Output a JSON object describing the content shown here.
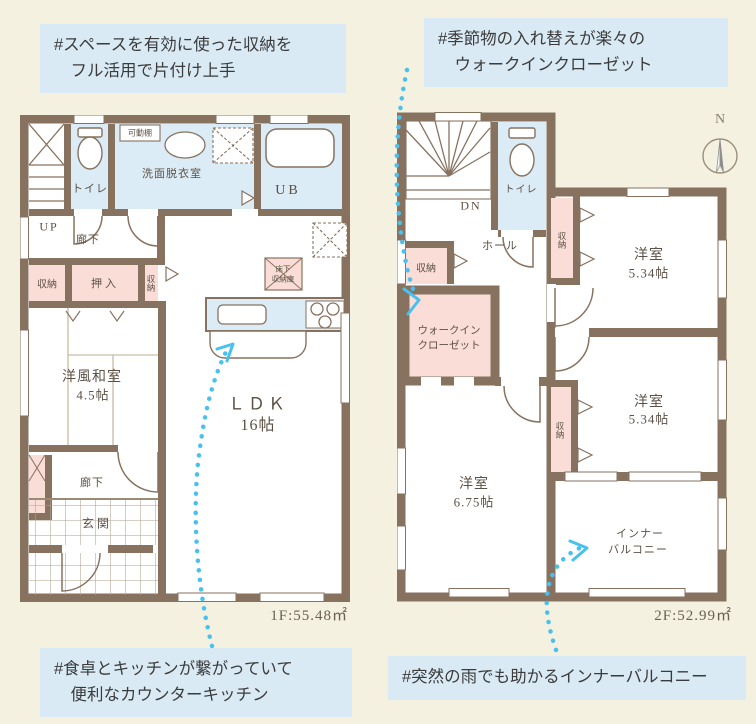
{
  "colors": {
    "background": "#f4f1e1",
    "wall": "#87725f",
    "room_blue": "#dcecf6",
    "room_pink": "#f9ddd6",
    "callout_bg": "#d9eaf5",
    "arrow_blue": "#49c1ef",
    "label_text": "#5c5146"
  },
  "callouts": {
    "storage": {
      "line1": "#スペースを有効に使った収納を",
      "line2": "フル活用で片付け上手"
    },
    "closet": {
      "line1": "#季節物の入れ替えが楽々の",
      "line2": "ウォークインクローゼット"
    },
    "kitchen": {
      "line1": "#食卓とキッチンが繋がっていて",
      "line2": "便利なカウンターキッチン"
    },
    "balcony": {
      "line1": "#突然の雨でも助かるインナーバルコニー"
    }
  },
  "floor1": {
    "area": "1F:55.48㎡",
    "labels": {
      "toilet": "トイレ",
      "shelf": "可動棚",
      "washroom": "洗面脱衣室",
      "bath": "UB",
      "up": "UP",
      "hall_upper": "廊下",
      "storage_a": "収納",
      "oshiire": "押入",
      "storage_b": "収納",
      "washitsu": "洋風和室",
      "washitsu_size": "4.5帖",
      "ldk": "ＬＤＫ",
      "ldk_size": "16帖",
      "floor_storage_1": "床下",
      "floor_storage_2": "収納庫",
      "hall_lower": "廊下",
      "entrance": "玄関"
    }
  },
  "floor2": {
    "area": "2F:52.99㎡",
    "labels": {
      "down": "DN",
      "toilet": "トイレ",
      "hall": "ホール",
      "storage_hall": "収納",
      "storage_b1": "収納",
      "bedroom1": "洋室",
      "bedroom1_size": "5.34帖",
      "wic_1": "ウォークイン",
      "wic_2": "クローゼット",
      "bedroom2": "洋室",
      "bedroom2_size": "5.34帖",
      "storage_b2": "収納",
      "bedroom3": "洋室",
      "bedroom3_size": "6.75帖",
      "balcony_1": "インナー",
      "balcony_2": "バルコニー"
    }
  },
  "compass": {
    "north": "N"
  }
}
